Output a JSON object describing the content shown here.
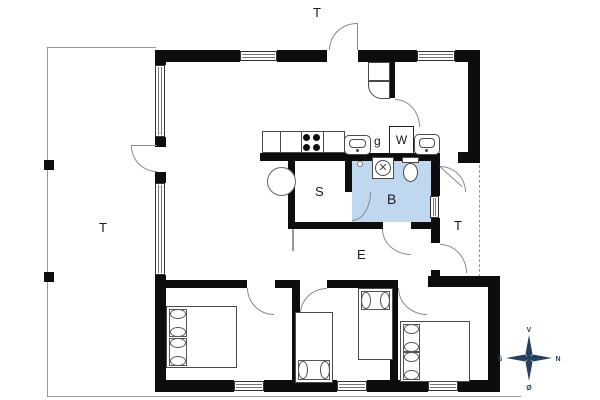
{
  "rooms": {
    "terrace_top_label": "T",
    "terrace_left_label": "T",
    "terrace_right_label": "T",
    "sauna_label": "S",
    "bathroom_label": "B",
    "hall_label": "E"
  },
  "fixtures": {
    "floor_drain_label": "g",
    "washing_machine_label": "W"
  },
  "compass": {
    "west": "V",
    "north": "N",
    "south": "S",
    "east": "Ø"
  },
  "colors": {
    "wall": "#0d0d0d",
    "bathroom_fill": "#bfd7ef",
    "compass_navy": "#27405f",
    "line_gray": "#999999"
  }
}
